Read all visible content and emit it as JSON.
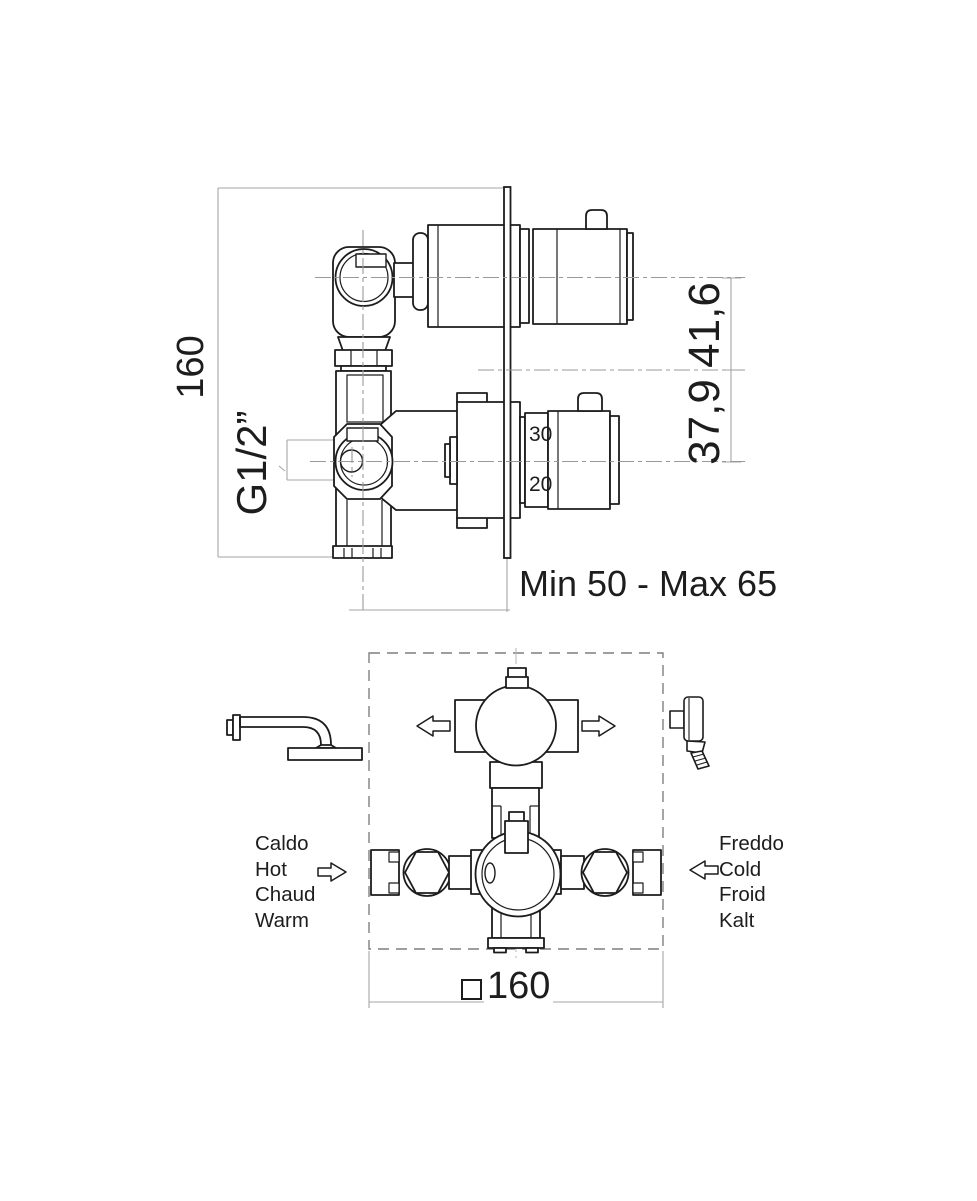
{
  "colors": {
    "line": "#1c1c1c",
    "centerline": "#999999",
    "extension": "#a6a6a6",
    "dashed_box": "#7f7f7f",
    "text": "#1d1d1d"
  },
  "side_view": {
    "height_dim": "160",
    "thread_label": "G1/2”",
    "upper_offset_dim": "41,6",
    "lower_offset_dim": "37,9",
    "dial_tick_upper": "30",
    "dial_tick_lower": "20",
    "depth_range_label": "Min 50 - Max 65"
  },
  "front_view": {
    "width_dim": "160",
    "hot_labels": [
      "Caldo",
      "Hot",
      "Chaud",
      "Warm"
    ],
    "cold_labels": [
      "Freddo",
      "Cold",
      "Froid",
      "Kalt"
    ]
  }
}
